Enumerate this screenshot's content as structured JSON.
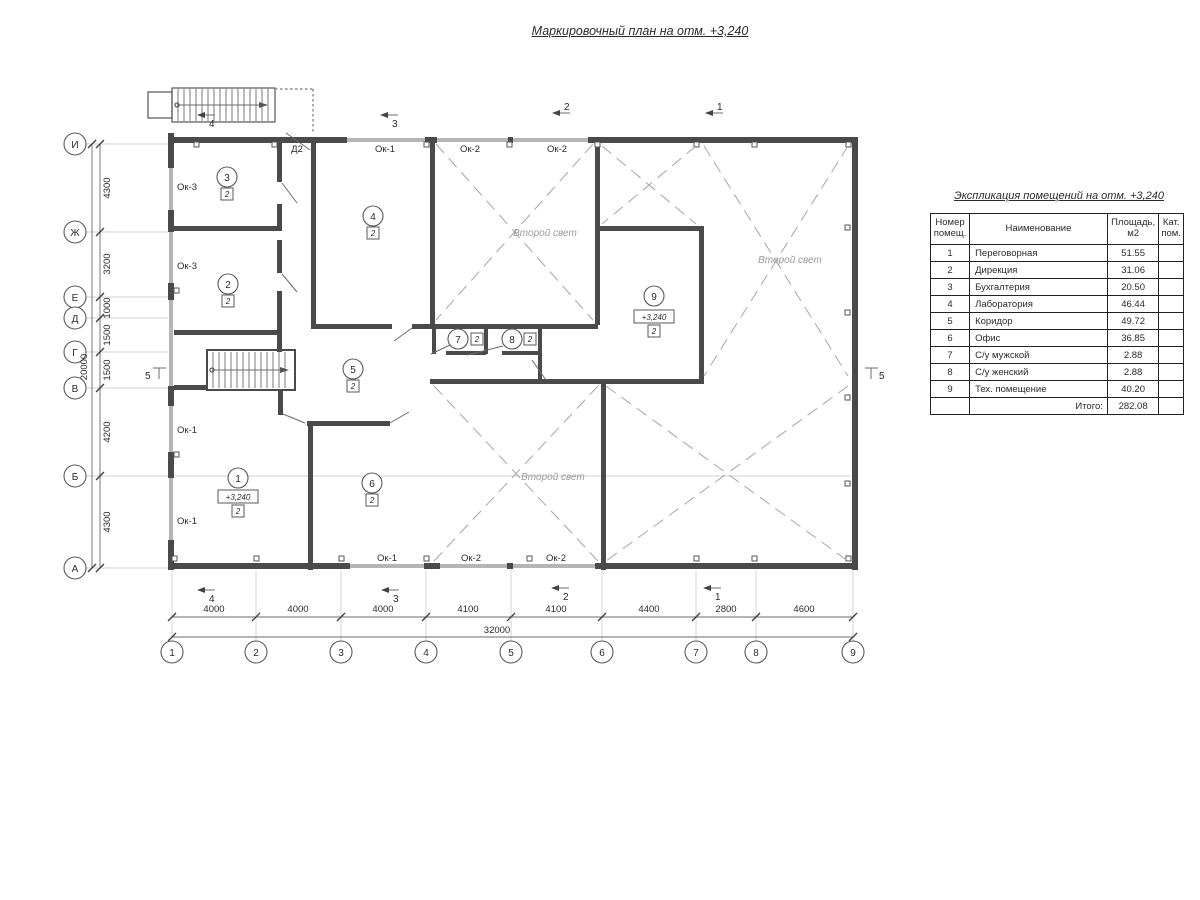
{
  "title": "Маркировочный план на отм. +3,240",
  "plan": {
    "second_light_label": "Второй свет",
    "door_label": "Д2",
    "level_mark": "+3,240",
    "window_labels": {
      "ok1": "Ок-1",
      "ok2": "Ок-2",
      "ok3": "Ок-3"
    },
    "rooms": [
      {
        "num": "1",
        "cat": "2"
      },
      {
        "num": "2",
        "cat": "2"
      },
      {
        "num": "3",
        "cat": "2"
      },
      {
        "num": "4",
        "cat": "2"
      },
      {
        "num": "5",
        "cat": "2"
      },
      {
        "num": "6",
        "cat": "2"
      },
      {
        "num": "7",
        "cat": "2"
      },
      {
        "num": "8",
        "cat": "2"
      },
      {
        "num": "9",
        "cat": "2"
      }
    ],
    "axes": {
      "rows": [
        "И",
        "Ж",
        "Е",
        "Д",
        "Г",
        "В",
        "Б",
        "А"
      ],
      "cols": [
        "1",
        "2",
        "3",
        "4",
        "5",
        "6",
        "7",
        "8",
        "9"
      ]
    },
    "dims": {
      "left": [
        "4300",
        "3200",
        "1000",
        "1500",
        "1500",
        "4200",
        "4300"
      ],
      "left_total": "20000",
      "bottom": [
        "4000",
        "4000",
        "4000",
        "4100",
        "4100",
        "4400",
        "2800",
        "4600"
      ],
      "bottom_total": "32000"
    },
    "sections": {
      "s1": "1",
      "s2": "2",
      "s3": "3",
      "s4": "4",
      "s5": "5"
    }
  },
  "table": {
    "title": "Экспликация помещений на отм. +3,240",
    "headers": {
      "num": "Номер помещ.",
      "name": "Наименование",
      "area": "Площадь, м2",
      "cat": "Кат. пом."
    },
    "rows": [
      {
        "num": "1",
        "name": "Переговорная",
        "area": "51.55",
        "cat": ""
      },
      {
        "num": "2",
        "name": "Дирекция",
        "area": "31.06",
        "cat": ""
      },
      {
        "num": "3",
        "name": "Бухгалтерия",
        "area": "20.50",
        "cat": ""
      },
      {
        "num": "4",
        "name": "Лаборатория",
        "area": "46.44",
        "cat": ""
      },
      {
        "num": "5",
        "name": "Коридор",
        "area": "49.72",
        "cat": ""
      },
      {
        "num": "6",
        "name": "Офис",
        "area": "36.85",
        "cat": ""
      },
      {
        "num": "7",
        "name": "С/у мужской",
        "area": "2.88",
        "cat": ""
      },
      {
        "num": "8",
        "name": "С/у женский",
        "area": "2.88",
        "cat": ""
      },
      {
        "num": "9",
        "name": "Тех. помещение",
        "area": "40.20",
        "cat": ""
      }
    ],
    "total_label": "Итого:",
    "total_value": "282.08"
  }
}
